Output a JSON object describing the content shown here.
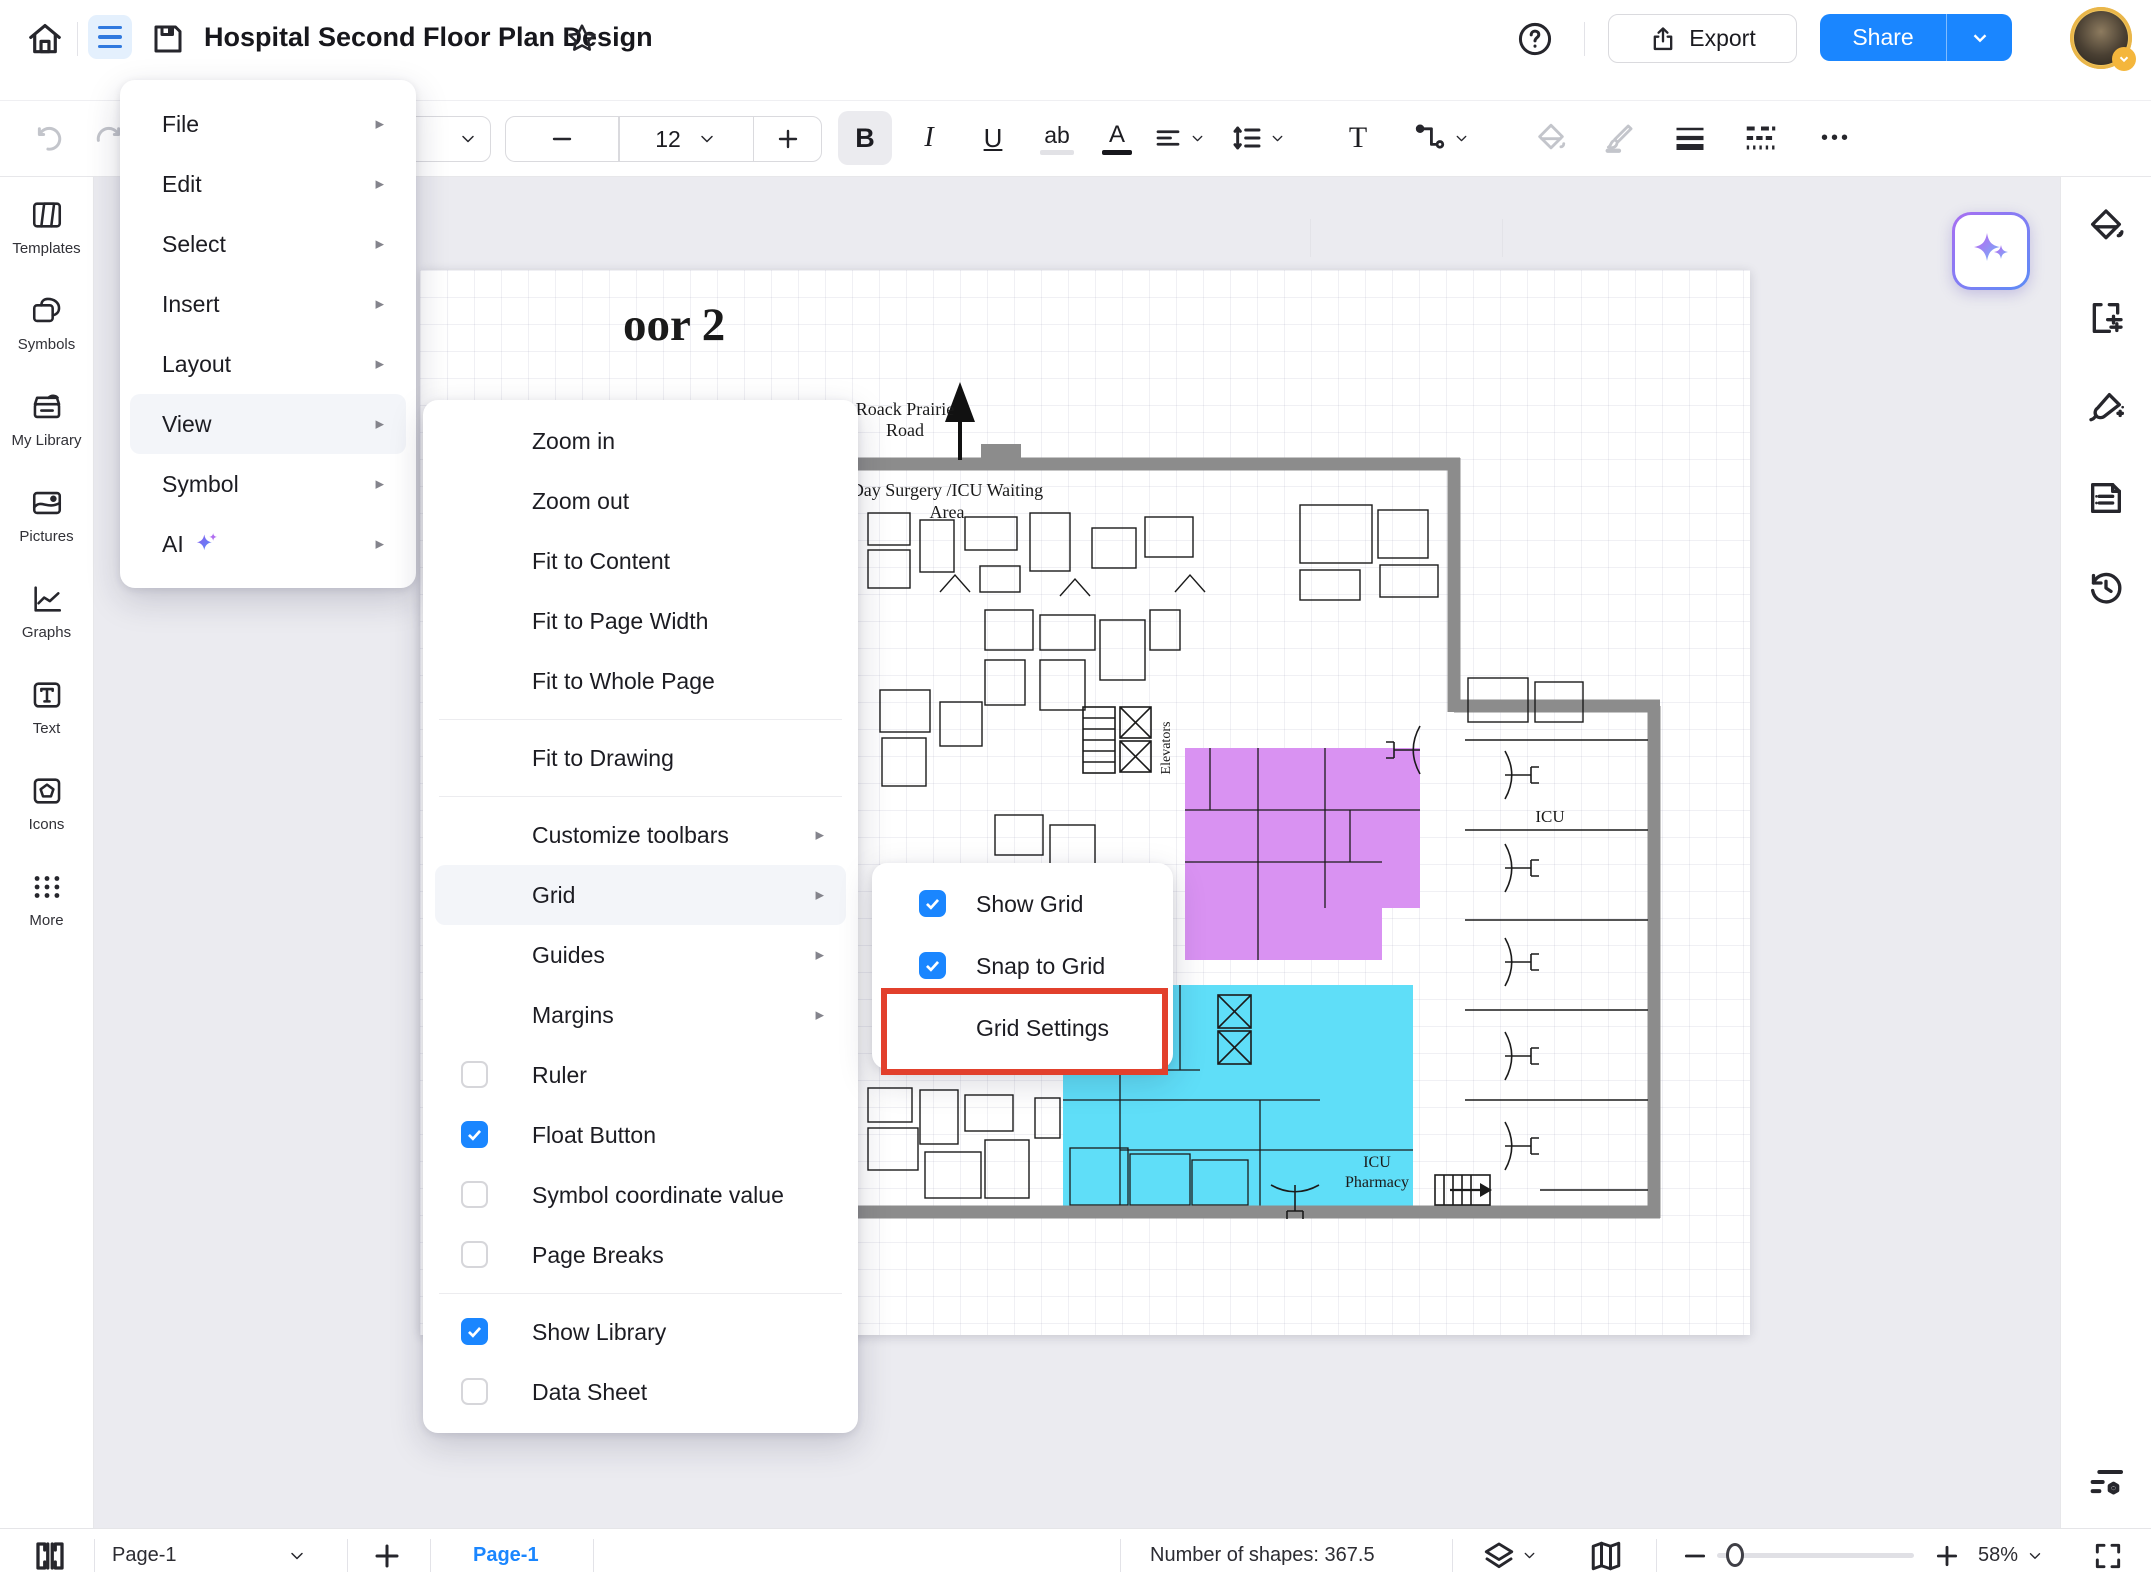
{
  "topbar": {
    "title": "Hospital Second Floor Plan Design",
    "export_label": "Export",
    "share_label": "Share"
  },
  "toolbar": {
    "font_size": "12",
    "bold": "B",
    "italic": "I",
    "underline": "U",
    "highlight": "ab",
    "font_color": "A",
    "text_tool": "T",
    "more": "•••"
  },
  "sidebar_left": {
    "items": [
      {
        "label": "Templates"
      },
      {
        "label": "Symbols"
      },
      {
        "label": "My Library"
      },
      {
        "label": "Pictures"
      },
      {
        "label": "Graphs"
      },
      {
        "label": "Text"
      },
      {
        "label": "Icons"
      },
      {
        "label": "More"
      }
    ]
  },
  "menu": {
    "items": [
      {
        "label": "File"
      },
      {
        "label": "Edit"
      },
      {
        "label": "Select"
      },
      {
        "label": "Insert"
      },
      {
        "label": "Layout"
      },
      {
        "label": "View",
        "active": true
      },
      {
        "label": "Symbol"
      },
      {
        "label": "AI"
      }
    ]
  },
  "view_menu": {
    "items_fit": [
      "Zoom in",
      "Zoom out",
      "Fit to Content",
      "Fit to Page Width",
      "Fit to Whole Page"
    ],
    "item_fit_drawing": "Fit to Drawing",
    "items_sub": [
      {
        "label": "Customize toolbars"
      },
      {
        "label": "Grid",
        "active": true
      },
      {
        "label": "Guides"
      },
      {
        "label": "Margins"
      }
    ],
    "items_check": [
      {
        "label": "Ruler",
        "checked": false
      },
      {
        "label": "Float Button",
        "checked": true
      },
      {
        "label": "Symbol coordinate value",
        "checked": false
      },
      {
        "label": "Page Breaks",
        "checked": false
      }
    ],
    "items_bottom": [
      {
        "label": "Show Library",
        "checked": true
      },
      {
        "label": "Data Sheet",
        "checked": false
      }
    ]
  },
  "grid_menu": {
    "show_grid": "Show Grid",
    "show_grid_checked": true,
    "snap_to_grid": "Snap to Grid",
    "snap_to_grid_checked": true,
    "grid_settings": "Grid Settings",
    "grid_settings_highlighted": true
  },
  "canvas": {
    "plan": {
      "title_partial": "oor 2",
      "road_line1": "Roack Prairie",
      "road_line2": "Road",
      "area_line1": "Day Surgery /ICU Waiting",
      "area_line2": "Area",
      "icu": "ICU",
      "pharmacy_line1": "ICU",
      "pharmacy_line2": "Pharmacy",
      "elevators": "Elevators"
    },
    "colors": {
      "accent_blue": "#1a86ff",
      "annotation_red": "#e2402c",
      "zone_purple": "#d992f2",
      "zone_cyan": "#5fdef8",
      "wall_gray": "#8c8c8c"
    }
  },
  "statusbar": {
    "page_dropdown": "Page-1",
    "active_page_tab": "Page-1",
    "shape_count": "Number of shapes: 367.5",
    "zoom": "58%"
  }
}
